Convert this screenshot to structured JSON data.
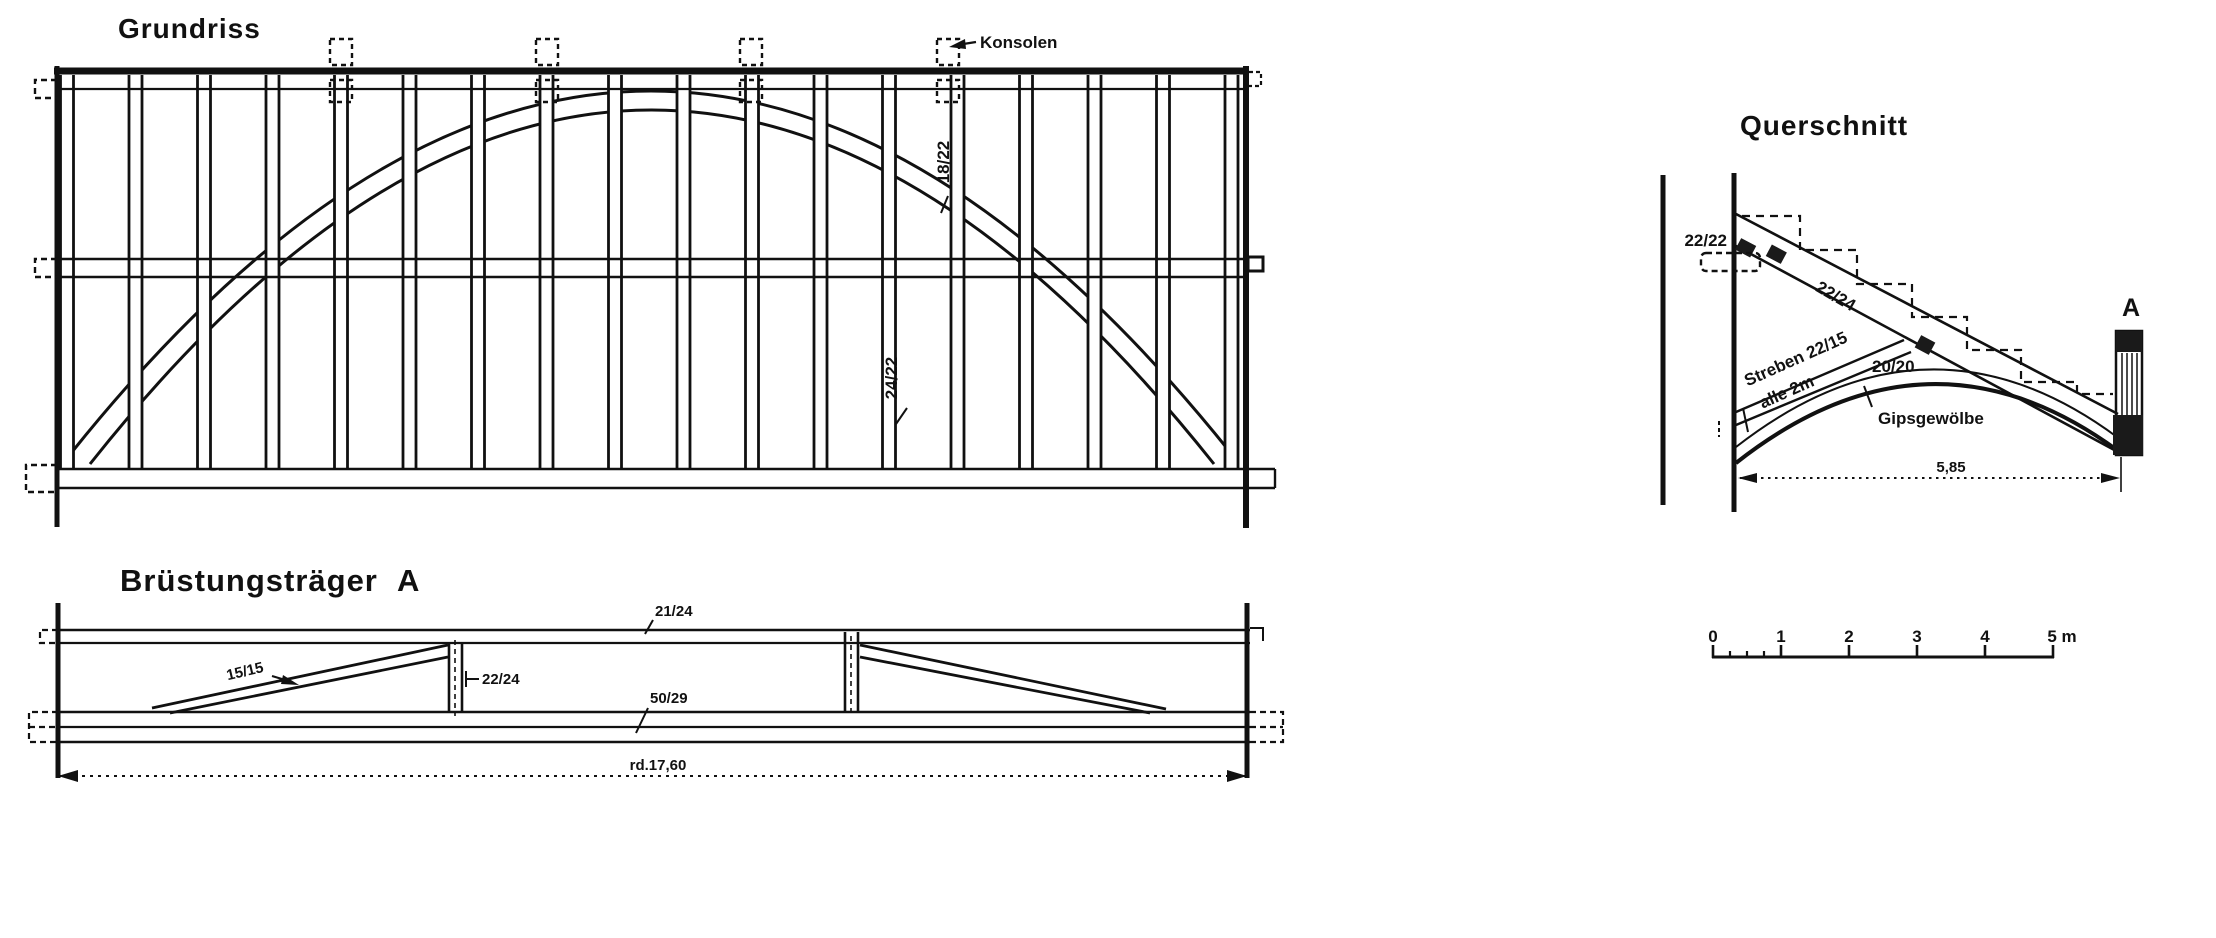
{
  "grundriss": {
    "title": "Grundriss",
    "labels": {
      "konsolen": "Konsolen",
      "arch_size": "18/22",
      "stud_size": "24/22"
    }
  },
  "bruestungstraeger": {
    "title": "Brüstungsträger",
    "mark": "A",
    "labels": {
      "diagonal_size": "15/15",
      "post_size": "22/24",
      "top_chord_size": "21/24",
      "bottom_chord_size": "50/29",
      "span": "rd.17,60"
    }
  },
  "querschnitt": {
    "title": "Querschnitt",
    "labels": {
      "wall_timber_size": "22/22",
      "rafter_size": "22/24",
      "strut_text": "Streben 22/15",
      "strut_spacing": "alle 2m",
      "strut_head_size": "20/20",
      "vault": "Gipsgewölbe",
      "section_mark": "A",
      "span": "5,85"
    }
  },
  "scalebar": {
    "labels": [
      "0",
      "1",
      "2",
      "3",
      "4",
      "5 m"
    ]
  }
}
